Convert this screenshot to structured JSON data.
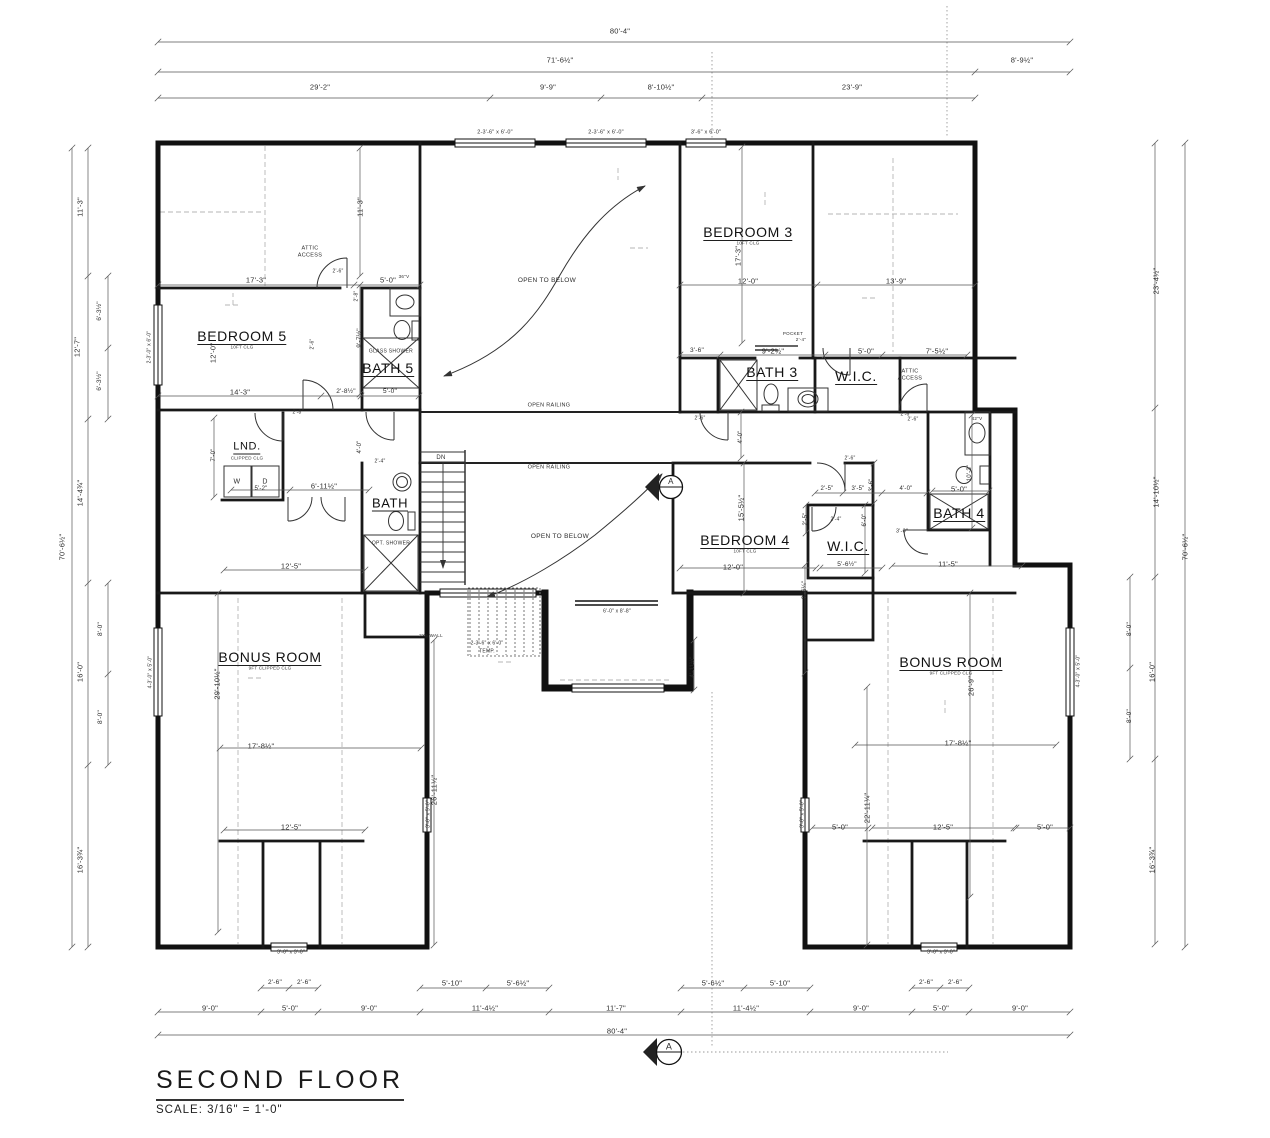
{
  "title_block": {
    "title": "SECOND FLOOR",
    "scale": "SCALE: 3/16\" = 1'-0\""
  },
  "colors": {
    "ink": "#111111",
    "dim_ink": "#2c2c2c",
    "dash": "#b5b5b5"
  },
  "rooms": [
    {
      "t": "BEDROOM 5",
      "sub": "10FT CLG",
      "x": 242,
      "y": 337
    },
    {
      "t": "BATH 5",
      "x": 388,
      "y": 369
    },
    {
      "t": "BEDROOM 3",
      "sub": "10FT CLG",
      "x": 748,
      "y": 233
    },
    {
      "t": "BATH 3",
      "x": 772,
      "y": 373
    },
    {
      "t": "W.I.C.",
      "x": 856,
      "y": 377
    },
    {
      "t": "LND.",
      "sub": "CLIPPED CLG",
      "x": 247,
      "y": 448,
      "s": 11
    },
    {
      "t": "BATH",
      "x": 390,
      "y": 504,
      "s": 13
    },
    {
      "t": "BEDROOM 4",
      "sub": "10FT CLG",
      "x": 745,
      "y": 541
    },
    {
      "t": "W.I.C.",
      "x": 848,
      "y": 547
    },
    {
      "t": "BATH 4",
      "x": 959,
      "y": 514
    },
    {
      "t": "BONUS ROOM",
      "sub": "9FT CLIPPED CLG",
      "x": 270,
      "y": 658
    },
    {
      "t": "BONUS ROOM",
      "sub": "9FT CLIPPED CLG",
      "x": 951,
      "y": 663
    }
  ],
  "dims": [
    {
      "t": "80'-4\"",
      "x": 620,
      "y": 31
    },
    {
      "t": "71'-6½\"",
      "x": 560,
      "y": 60
    },
    {
      "t": "8'-9½\"",
      "x": 1022,
      "y": 60
    },
    {
      "t": "29'-2\"",
      "x": 320,
      "y": 87
    },
    {
      "t": "9'-9\"",
      "x": 548,
      "y": 87
    },
    {
      "t": "8'-10½\"",
      "x": 661,
      "y": 87
    },
    {
      "t": "23'-9\"",
      "x": 852,
      "y": 87
    },
    {
      "t": "11'-3\"",
      "x": 80,
      "y": 207,
      "r": -90
    },
    {
      "t": "12'-7\"",
      "x": 77,
      "y": 347,
      "r": -90
    },
    {
      "t": "6'-3½\"",
      "x": 100,
      "y": 311,
      "r": -90,
      "s": 6.5
    },
    {
      "t": "6'-3½\"",
      "x": 100,
      "y": 381,
      "r": -90,
      "s": 6.5
    },
    {
      "t": "14'-4¾\"",
      "x": 80,
      "y": 493,
      "r": -90
    },
    {
      "t": "70'-6½\"",
      "x": 62,
      "y": 547,
      "r": -90
    },
    {
      "t": "8'-0\"",
      "x": 101,
      "y": 629,
      "r": -90,
      "s": 6.5
    },
    {
      "t": "16'-0\"",
      "x": 80,
      "y": 672,
      "r": -90
    },
    {
      "t": "8'-0\"",
      "x": 101,
      "y": 717,
      "r": -90,
      "s": 6.5
    },
    {
      "t": "16'-3¾\"",
      "x": 80,
      "y": 860,
      "r": -90
    },
    {
      "t": "23'-4½\"",
      "x": 1156,
      "y": 281,
      "r": -90
    },
    {
      "t": "14'-10½\"",
      "x": 1156,
      "y": 492,
      "r": -90
    },
    {
      "t": "70'-6½\"",
      "x": 1185,
      "y": 547,
      "r": -90
    },
    {
      "t": "8'-0\"",
      "x": 1130,
      "y": 629,
      "r": -90,
      "s": 6.5
    },
    {
      "t": "16'-0\"",
      "x": 1152,
      "y": 672,
      "r": -90
    },
    {
      "t": "8'-0\"",
      "x": 1130,
      "y": 716,
      "r": -90,
      "s": 6.5
    },
    {
      "t": "16'-3¾\"",
      "x": 1152,
      "y": 860,
      "r": -90
    },
    {
      "t": "2'-6\"",
      "x": 275,
      "y": 983,
      "s": 6.5
    },
    {
      "t": "2'-6\"",
      "x": 304,
      "y": 983,
      "s": 6.5
    },
    {
      "t": "5'-10\"",
      "x": 452,
      "y": 983
    },
    {
      "t": "5'-6½\"",
      "x": 518,
      "y": 983
    },
    {
      "t": "5'-6½\"",
      "x": 713,
      "y": 983
    },
    {
      "t": "5'-10\"",
      "x": 780,
      "y": 983
    },
    {
      "t": "2'-6\"",
      "x": 926,
      "y": 983,
      "s": 6.5
    },
    {
      "t": "2'-6\"",
      "x": 955,
      "y": 983,
      "s": 6.5
    },
    {
      "t": "9'-0\"",
      "x": 210,
      "y": 1008
    },
    {
      "t": "5'-0\"",
      "x": 290,
      "y": 1008
    },
    {
      "t": "9'-0\"",
      "x": 369,
      "y": 1008
    },
    {
      "t": "11'-4½\"",
      "x": 485,
      "y": 1008
    },
    {
      "t": "11'-7\"",
      "x": 616,
      "y": 1008
    },
    {
      "t": "11'-4½\"",
      "x": 746,
      "y": 1008
    },
    {
      "t": "9'-0\"",
      "x": 861,
      "y": 1008
    },
    {
      "t": "5'-0\"",
      "x": 941,
      "y": 1008
    },
    {
      "t": "9'-0\"",
      "x": 1020,
      "y": 1008
    },
    {
      "t": "80'-4\"",
      "x": 617,
      "y": 1031
    },
    {
      "t": "17'-3\"",
      "x": 256,
      "y": 280
    },
    {
      "t": "5'-0\"",
      "x": 388,
      "y": 280
    },
    {
      "t": "11'-3\"",
      "x": 360,
      "y": 207,
      "r": -90
    },
    {
      "t": "9'-7½\"",
      "x": 360,
      "y": 338,
      "r": -90,
      "s": 6.5
    },
    {
      "t": "12'-0\"",
      "x": 213,
      "y": 353,
      "r": -90
    },
    {
      "t": "14'-3\"",
      "x": 240,
      "y": 392
    },
    {
      "t": "2'-8½\"",
      "x": 346,
      "y": 392,
      "s": 6.5
    },
    {
      "t": "5'-0\"",
      "x": 390,
      "y": 392,
      "s": 6.5
    },
    {
      "t": "17'-3\"",
      "x": 738,
      "y": 256,
      "r": -90
    },
    {
      "t": "12'-0\"",
      "x": 748,
      "y": 281
    },
    {
      "t": "13'-9\"",
      "x": 896,
      "y": 281
    },
    {
      "t": "3'-6\"",
      "x": 697,
      "y": 351,
      "s": 6.5
    },
    {
      "t": "9'-2½\"",
      "x": 773,
      "y": 351
    },
    {
      "t": "5'-0\"",
      "x": 866,
      "y": 351
    },
    {
      "t": "7'-5½\"",
      "x": 937,
      "y": 351
    },
    {
      "t": "5'-2\"",
      "x": 261,
      "y": 489,
      "s": 6
    },
    {
      "t": "6'-11½\"",
      "x": 324,
      "y": 486
    },
    {
      "t": "7'-0\"",
      "x": 214,
      "y": 455,
      "r": -90,
      "s": 6
    },
    {
      "t": "4'-0\"",
      "x": 360,
      "y": 447,
      "r": -90,
      "s": 6
    },
    {
      "t": "4'-0\"",
      "x": 741,
      "y": 437,
      "r": -90,
      "s": 6
    },
    {
      "t": "12'-5\"",
      "x": 291,
      "y": 566
    },
    {
      "t": "12'-0\"",
      "x": 733,
      "y": 567
    },
    {
      "t": "5'-6½\"",
      "x": 847,
      "y": 565,
      "s": 6.5
    },
    {
      "t": "11'-5\"",
      "x": 948,
      "y": 564
    },
    {
      "t": "2'-5\"",
      "x": 827,
      "y": 489,
      "s": 6
    },
    {
      "t": "3'-5\"",
      "x": 858,
      "y": 489,
      "s": 6
    },
    {
      "t": "3'-6\"",
      "x": 872,
      "y": 485,
      "r": -90,
      "s": 6
    },
    {
      "t": "4'-0\"",
      "x": 906,
      "y": 489,
      "s": 6
    },
    {
      "t": "2'-5\"",
      "x": 806,
      "y": 519,
      "r": -90,
      "s": 6
    },
    {
      "t": "6'-0\"",
      "x": 865,
      "y": 520,
      "r": -90,
      "s": 6
    },
    {
      "t": "3'-0\"",
      "x": 902,
      "y": 532,
      "s": 5.5
    },
    {
      "t": "5'-0\"",
      "x": 959,
      "y": 489
    },
    {
      "t": "10'-3\"",
      "x": 970,
      "y": 473,
      "r": -90,
      "s": 6
    },
    {
      "t": "9'-6¼\"",
      "x": 805,
      "y": 590,
      "r": -90,
      "s": 6
    },
    {
      "t": "15'-5½\"",
      "x": 741,
      "y": 508,
      "r": -90
    },
    {
      "t": "17'-8½\"",
      "x": 261,
      "y": 746
    },
    {
      "t": "17'-8½\"",
      "x": 958,
      "y": 743
    },
    {
      "t": "29'-10½\"",
      "x": 217,
      "y": 684,
      "r": -90
    },
    {
      "t": "26'-9\"",
      "x": 971,
      "y": 686,
      "r": -90
    },
    {
      "t": "26'-11½\"",
      "x": 434,
      "y": 790,
      "r": -90
    },
    {
      "t": "22'-11¼\"",
      "x": 867,
      "y": 808,
      "r": -90
    },
    {
      "t": "12'-5\"",
      "x": 291,
      "y": 827
    },
    {
      "t": "5'-0\"",
      "x": 840,
      "y": 827
    },
    {
      "t": "12'-5\"",
      "x": 943,
      "y": 827
    },
    {
      "t": "5'-0\"",
      "x": 1045,
      "y": 827
    },
    {
      "t": "4'-11½\"",
      "x": 693,
      "y": 667,
      "r": -90,
      "s": 6
    },
    {
      "t": "2'-6\"",
      "x": 338,
      "y": 272,
      "s": 5
    },
    {
      "t": "2'-8\"",
      "x": 357,
      "y": 296,
      "r": -90,
      "s": 5
    },
    {
      "t": "2'-6\"",
      "x": 313,
      "y": 344,
      "r": -90,
      "s": 5
    },
    {
      "t": "2'-8\"",
      "x": 298,
      "y": 413,
      "s": 5
    },
    {
      "t": "2'-4\"",
      "x": 380,
      "y": 462,
      "s": 5
    },
    {
      "t": "2'-6\"",
      "x": 700,
      "y": 419,
      "s": 5
    },
    {
      "t": "2'-4\"",
      "x": 836,
      "y": 520,
      "s": 5
    },
    {
      "t": "2'-6\"",
      "x": 850,
      "y": 459,
      "s": 5
    },
    {
      "t": "2'-6\"",
      "x": 913,
      "y": 420,
      "s": 5
    },
    {
      "t": "2'-6\"",
      "x": 906,
      "y": 415,
      "s": 5
    },
    {
      "t": "2-3'-6\" x 6'-0\"",
      "x": 495,
      "y": 133,
      "s": 5.5
    },
    {
      "t": "2-3'-6\" x 6'-0\"",
      "x": 606,
      "y": 133,
      "s": 5.5
    },
    {
      "t": "3'-6\" x 6'-0\"",
      "x": 706,
      "y": 133,
      "s": 5.5
    },
    {
      "t": "2-3'-0\" x 6'-0\"",
      "x": 150,
      "y": 347,
      "r": -90,
      "s": 5
    },
    {
      "t": "4-3'-0\" x 5'-0\"",
      "x": 151,
      "y": 672,
      "r": -90,
      "s": 5
    },
    {
      "t": "4-3'-0\" x 5'-0\"",
      "x": 1079,
      "y": 671,
      "r": -90,
      "s": 5
    },
    {
      "t": "3'-0\" x 5'-0\"",
      "x": 429,
      "y": 814,
      "r": -90,
      "s": 5
    },
    {
      "t": "3'-0\" x 5'-0\"",
      "x": 803,
      "y": 814,
      "r": -90,
      "s": 5
    },
    {
      "t": "3'-0\" x 3'-0\"",
      "x": 291,
      "y": 953,
      "s": 5
    },
    {
      "t": "3'-0\" x 3'-0\"",
      "x": 941,
      "y": 953,
      "s": 5
    },
    {
      "t": "2-3'-6\" x 6'-0\"",
      "x": 487,
      "y": 644,
      "s": 5
    },
    {
      "t": "TEMP.",
      "x": 487,
      "y": 652,
      "s": 5
    },
    {
      "t": "6'-0\" x 8'-8\"",
      "x": 617,
      "y": 612,
      "s": 5
    }
  ],
  "annos": [
    {
      "t": "ATTIC",
      "x": 310,
      "y": 249
    },
    {
      "t": "ACCESS",
      "x": 310,
      "y": 256
    },
    {
      "t": "ATTIC",
      "x": 910,
      "y": 372
    },
    {
      "t": "ACCESS",
      "x": 910,
      "y": 379
    },
    {
      "t": "GLASS SHOWER",
      "x": 391,
      "y": 352,
      "s": 5
    },
    {
      "t": "OPT. SHOWER",
      "x": 391,
      "y": 544,
      "s": 5
    },
    {
      "t": "OPEN TO BELOW",
      "x": 547,
      "y": 281,
      "s": 6.5
    },
    {
      "t": "OPEN RAILING",
      "x": 549,
      "y": 406,
      "s": 5.5
    },
    {
      "t": "OPEN RAILING",
      "x": 549,
      "y": 468,
      "s": 5.5
    },
    {
      "t": "OPEN TO BELOW",
      "x": 560,
      "y": 537,
      "s": 6.5
    },
    {
      "t": "POCKET",
      "x": 793,
      "y": 334,
      "s": 4.5
    },
    {
      "t": "2'-4\"",
      "x": 801,
      "y": 340,
      "s": 4.5
    },
    {
      "t": "DN",
      "x": 441,
      "y": 458,
      "s": 6
    },
    {
      "t": "W",
      "x": 237,
      "y": 482,
      "s": 7
    },
    {
      "t": "D",
      "x": 265,
      "y": 482,
      "s": 7
    },
    {
      "t": "36\"V",
      "x": 404,
      "y": 277,
      "s": 4.5
    },
    {
      "t": "42\"V",
      "x": 977,
      "y": 419,
      "s": 4.5
    },
    {
      "t": "2X6 WALL",
      "x": 431,
      "y": 636,
      "s": 4.5
    },
    {
      "t": "A",
      "x": 671,
      "y": 482,
      "s": 8
    },
    {
      "t": "A",
      "x": 669,
      "y": 1047,
      "s": 9
    }
  ]
}
